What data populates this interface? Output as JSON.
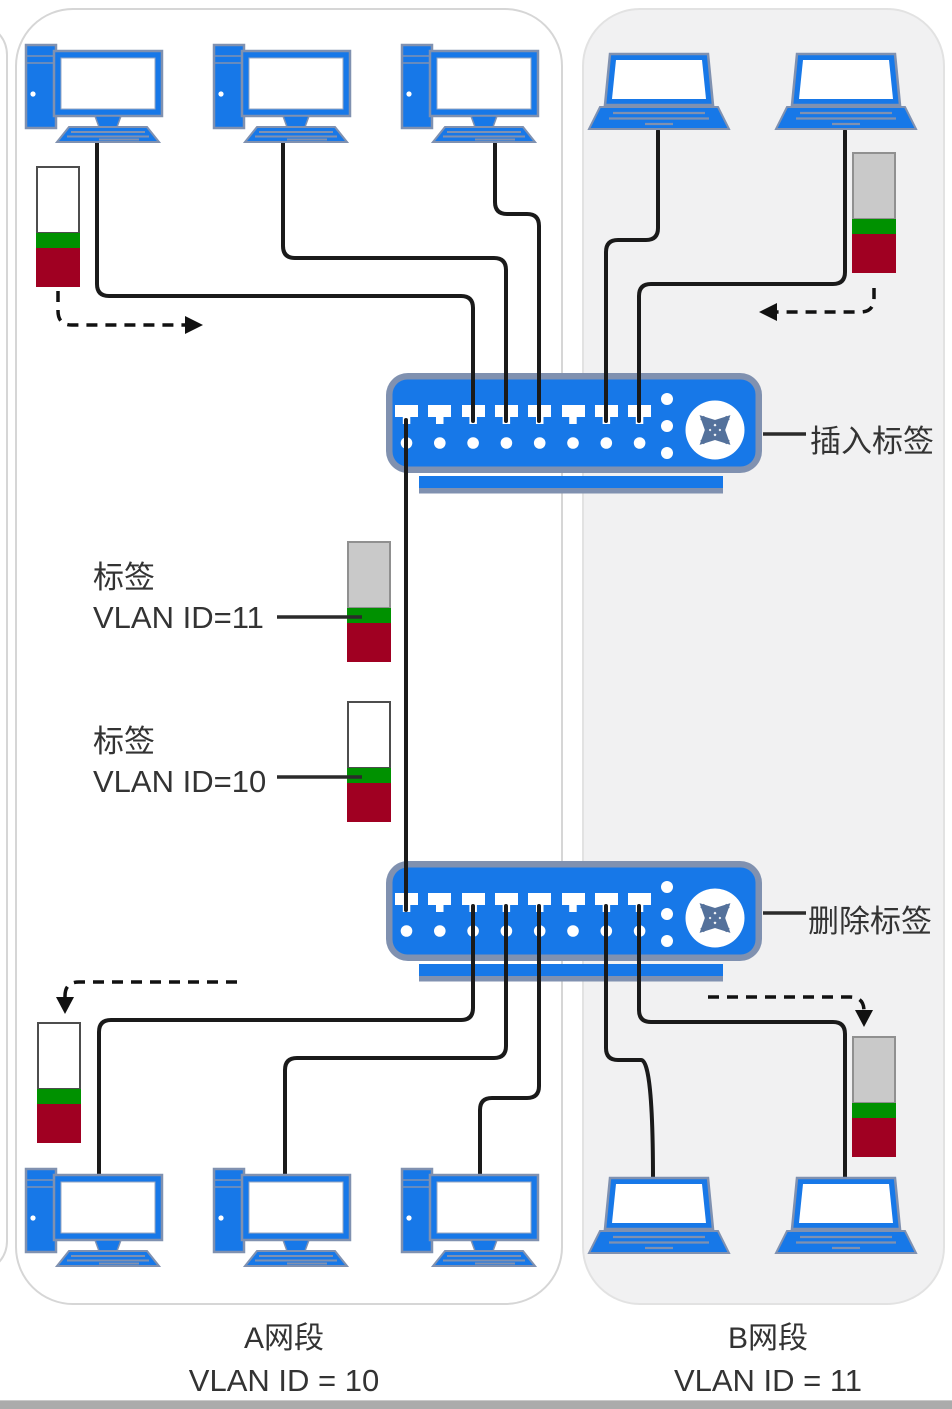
{
  "diagram_title": "VLAN tagging between two switches",
  "switches": {
    "top": {
      "label": "插入标签"
    },
    "bottom": {
      "label": "删除标签"
    }
  },
  "tag_callouts": {
    "vlan11": {
      "line1": "标签",
      "line2": "VLAN ID=11"
    },
    "vlan10": {
      "line1": "标签",
      "line2": "VLAN ID=10"
    }
  },
  "segments": {
    "a": {
      "title": "A网段",
      "vlan": "VLAN ID = 10"
    },
    "b": {
      "title": "B网段",
      "vlan": "VLAN ID = 11"
    }
  },
  "icons": {
    "desktop": "desktop-computer-icon",
    "laptop": "laptop-icon",
    "switch": "ethernet-switch-icon",
    "switch_glyph": "crossed-arrows-icon",
    "tag_vlan10": "vlan10-frame-tag-icon",
    "tag_vlan11": "vlan11-frame-tag-icon",
    "flow_arrow": "dashed-flow-arrow-icon"
  },
  "colors": {
    "device_blue": "#1778e8",
    "outline_slate": "#8091b0",
    "tag_green": "#009100",
    "tag_red": "#a00022",
    "tag_gray_top": "#c9c9c9",
    "tag_white_top": "#ffffff",
    "cable": "#1a1a1a",
    "segment_b_bg": "#f1f1f2",
    "box_border": "#d6d6d6",
    "text": "#333333"
  }
}
